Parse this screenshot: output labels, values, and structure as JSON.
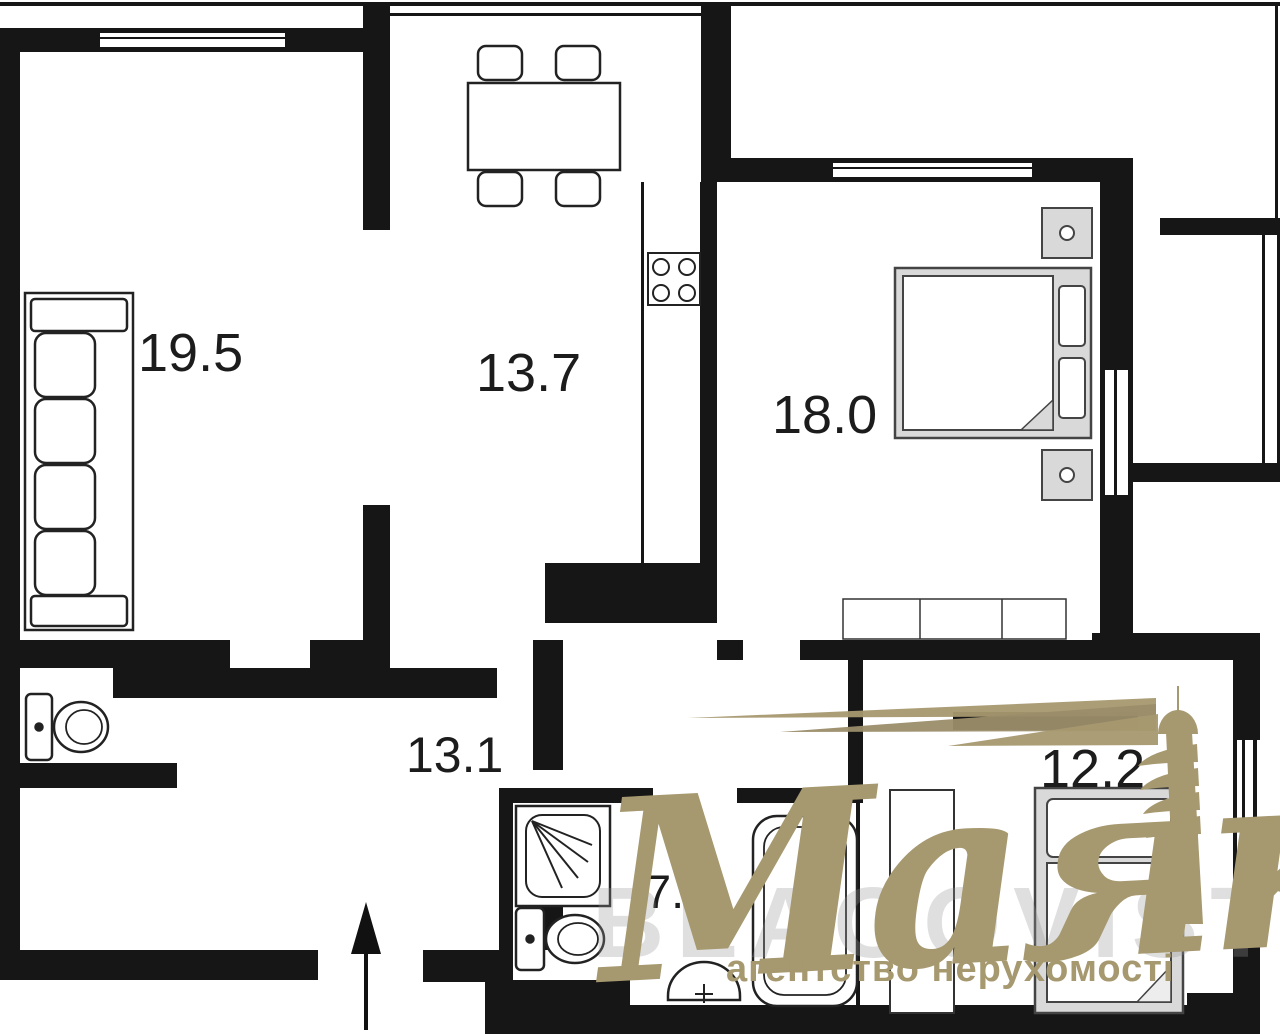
{
  "plan": {
    "rooms": {
      "living": {
        "area_label": "19.5"
      },
      "kitchen": {
        "area_label": "13.7"
      },
      "bedroom": {
        "area_label": "18.0"
      },
      "hallway": {
        "area_label": "13.1"
      },
      "bathroom": {
        "area_label": "7.2"
      },
      "bedroom2": {
        "area_label": "12.2"
      }
    },
    "colors": {
      "wall": "#161616",
      "furniture_fill": "#d9d9d9",
      "outline": "#2a2a2a",
      "watermark": "#a6986f",
      "background": "#ffffff"
    }
  },
  "watermark": {
    "brand": "Маяк",
    "tagline": "агентство нерухомості",
    "background_text": "BLAGOVIST"
  }
}
